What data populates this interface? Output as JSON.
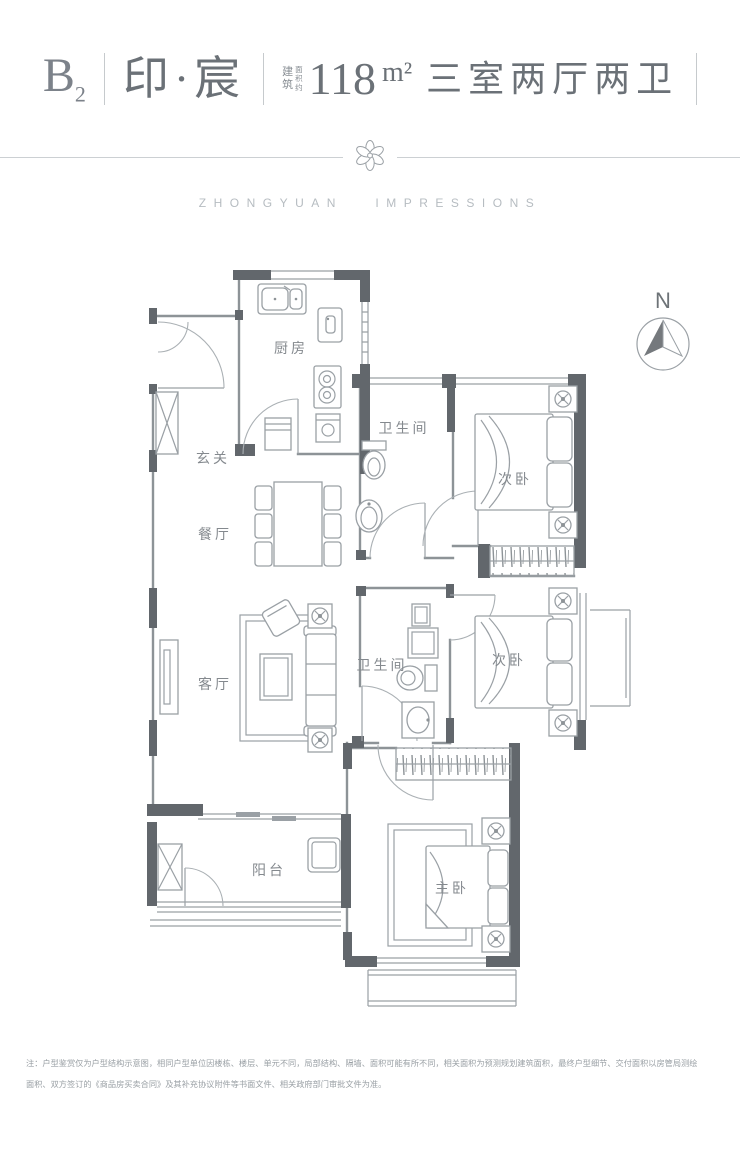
{
  "header": {
    "unit_letter": "B",
    "unit_number": "2",
    "project_name": "印·宸",
    "area_label_col1": "建筑",
    "area_label_col2": "面积约",
    "area_value": "118",
    "area_unit": "m²",
    "layout_desc": "三室两厅两卫"
  },
  "brand": {
    "wordmark": "ZHONGYUAN   IMPRESSIONS"
  },
  "compass": {
    "label": "N"
  },
  "rooms": {
    "entry": "玄关",
    "kitchen": "厨房",
    "bath_upper": "卫生间",
    "bedroom_upper": "次卧",
    "dining": "餐厅",
    "living": "客厅",
    "bath_lower": "卫生间",
    "bedroom_middle": "次卧",
    "balcony": "阳台",
    "master_bedroom": "主卧"
  },
  "footnote": {
    "line1": "注：户型鉴赏仅为户型结构示意图，相同户型单位因楼栋、楼层、单元不同，局部结构、隔墙、面积可能有所不同，相关面积为预测规划建筑面积，最终户型细节、交付面积以房管局测绘",
    "line2": "面积、双方签订的《商品房买卖合同》及其补充协议附件等书面文件、相关政府部门审批文件为准。"
  },
  "colors": {
    "wall_dark": "#62676c",
    "plan_line": "#9aa0a5",
    "label_text": "#84898e",
    "header_text": "#6b7177",
    "muted": "#b6bcc1"
  }
}
